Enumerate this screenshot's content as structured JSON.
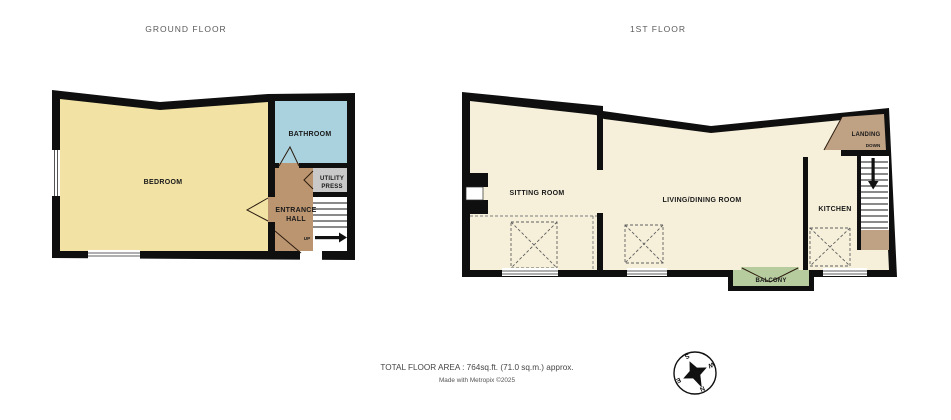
{
  "ground_floor": {
    "title": "GROUND FLOOR",
    "rooms": {
      "bedroom": "BEDROOM",
      "bathroom": "BATHROOM",
      "utility_line1": "UTILITY",
      "utility_line2": "PRESS",
      "hall_line1": "ENTRANCE",
      "hall_line2": "HALL"
    },
    "stairs_direction": "UP"
  },
  "first_floor": {
    "title": "1ST FLOOR",
    "rooms": {
      "sitting": "SITTING ROOM",
      "living": "LIVING/DINING ROOM",
      "kitchen": "KITCHEN",
      "landing": "LANDING",
      "balcony": "BALCONY"
    },
    "stairs_direction": "DOWN"
  },
  "footer": {
    "total_area": "TOTAL FLOOR AREA : 764sq.ft. (71.0 sq.m.) approx.",
    "credit": "Made with Metropix ©2025"
  },
  "compass": {
    "north": "N",
    "south": "S",
    "east": "E",
    "west": "W"
  },
  "colors": {
    "wall": "#0f0f0f",
    "bedroom": "#f2e3a5",
    "bathroom": "#aad2de",
    "hall": "#bb9570",
    "utility": "#c9c9c9",
    "cream": "#f6f0da",
    "landing": "#bfa184",
    "balcony": "#b6cc9f",
    "window": "#ffffff",
    "stairs": "#ffffff"
  }
}
